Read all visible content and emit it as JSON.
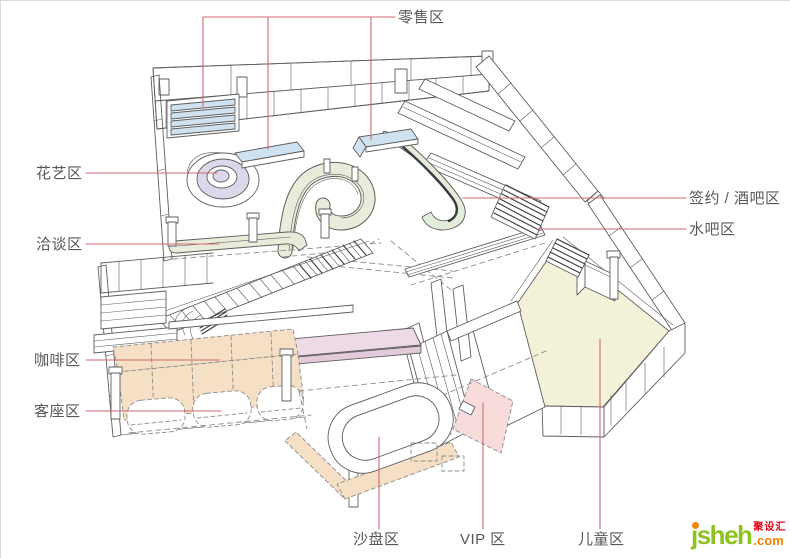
{
  "labels": [
    {
      "id": "retail",
      "text": "零售区"
    },
    {
      "id": "floral",
      "text": "花艺区"
    },
    {
      "id": "negotiation",
      "text": "洽谈区"
    },
    {
      "id": "coffee",
      "text": "咖啡区"
    },
    {
      "id": "guest",
      "text": "客座区"
    },
    {
      "id": "sand_table",
      "text": "沙盘区"
    },
    {
      "id": "vip",
      "text": "VIP 区"
    },
    {
      "id": "children",
      "text": "儿童区"
    },
    {
      "id": "signing_bar",
      "text": "签约 / 酒吧区"
    },
    {
      "id": "water_bar",
      "text": "水吧区"
    }
  ],
  "logo": {
    "brand": "jsheh",
    "cn": "聚设汇",
    "suffix": ".com"
  },
  "colors": {
    "stroke": "#5f5d5d",
    "leader": "#d2696f",
    "label_text": "#595757",
    "blue": "#cfe2f1",
    "lavender": "#dcd8eb",
    "mint": "#e4ecda",
    "beige": "#e9ecda",
    "pink": "#eedae7",
    "pink_dark": "#e3cadb",
    "peach": "#f5dfc5",
    "vip_pink": "#f8dcdb",
    "cream": "#f4f1d9",
    "dark": "#3c3c3c",
    "dashc": "#8c8c8c",
    "border": "#d9d9d9",
    "logo_green": "#8dc21f",
    "logo_orange": "#f08300",
    "logo_red": "#e60012"
  }
}
